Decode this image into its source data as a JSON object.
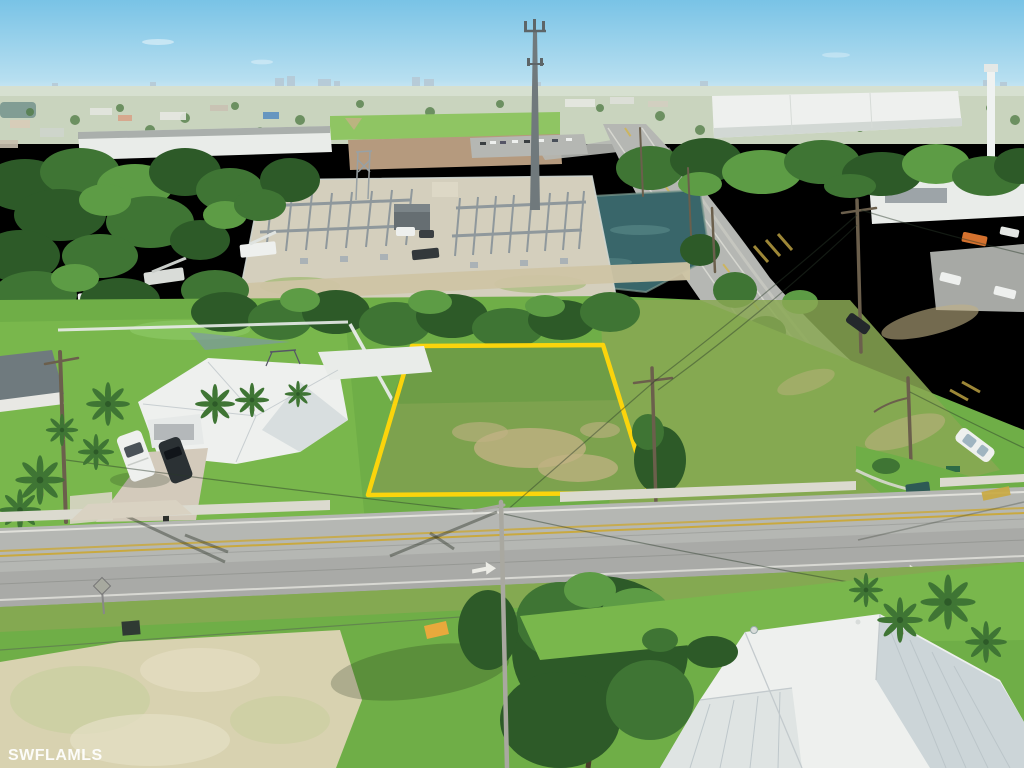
{
  "watermark": {
    "text": "SWFLAMLS"
  },
  "palette": {
    "sky-top": "#79c3e6",
    "sky-horizon": "#dcedf5",
    "skyline": "#b6c8d4",
    "city-base": "#c9d4be",
    "city-tree": "#4e7a42",
    "field": "#8fc563",
    "treeline-dark": "#2d5a28",
    "treeline-mid": "#3f7534",
    "treeline-light": "#5d9c45",
    "lawn": "#79b74c",
    "lawn-light": "#8cc765",
    "grass-mid": "#6fae47",
    "grass-olive": "#8aa854",
    "patch-tan": "#c0b183",
    "sand": "#d8d2b0",
    "sand-mottle": "#c9cf9f",
    "asphalt": "#b5b7b3",
    "asphalt-dark": "#a7a9a5",
    "concrete": "#dbdacf",
    "paver": "#d3cabb",
    "roof-white": "#eef0ee",
    "roof-shade": "#ccd5d8",
    "wall-white": "#e9ece9",
    "steel": "#8f989c",
    "steel-pole": "#a9a8a0",
    "gravel": "#d4cfbd",
    "dirt": "#cfc4a4",
    "water": "#39666a",
    "lot-outline": "#ffd60a",
    "road-yellow": "#c9a93f",
    "marking-white": "#ecece6",
    "truck-white": "#eef0ee",
    "vehicle-dark": "#2b3134",
    "wood": "#6b5f4c",
    "wire": "#2b3a2b",
    "shadow": "rgba(22,38,18,0.40)",
    "orange": "#e8a93c",
    "orange-truck": "#d4712e",
    "blue-roof": "#5b8fc0",
    "enclosure": "#7c97a6",
    "sign-green": "#2e6b46",
    "watermark": "rgba(255,255,255,0.92)"
  }
}
